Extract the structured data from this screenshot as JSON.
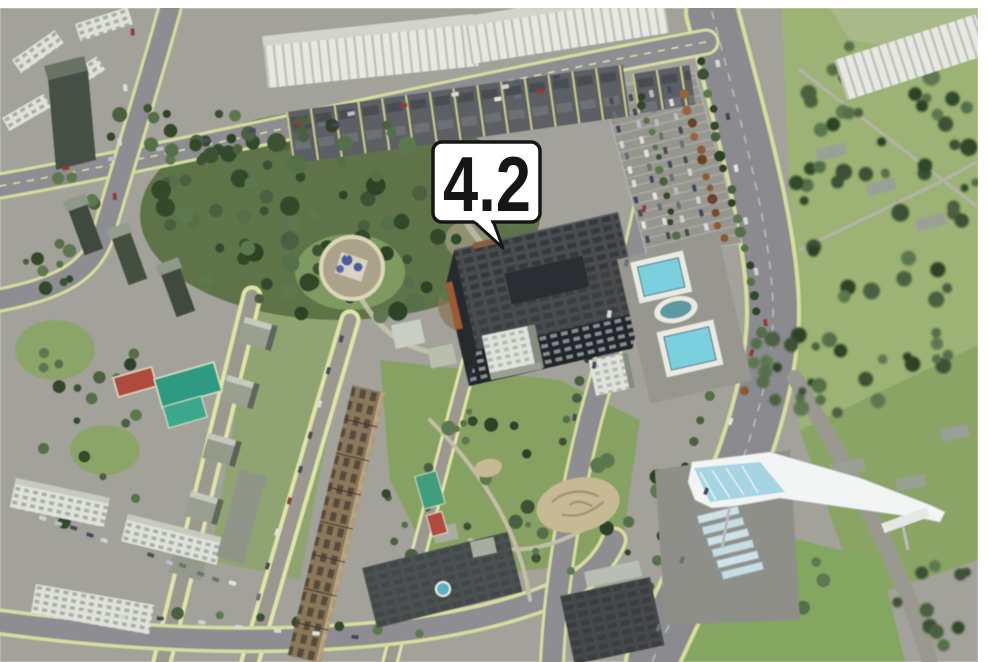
{
  "map": {
    "marker": {
      "label": "4.2",
      "bg_color": "#ffffff",
      "border_color": "#161616",
      "text_color": "#161616"
    },
    "colors": {
      "frame": "#ffffff",
      "ground": "#a3a29a",
      "road": "#8b8b8f",
      "road_edge_marking": "#dce39f",
      "grass": "#8aa465",
      "forest_tree": "#3d5135",
      "highlighted_building_roof": "#43464a",
      "highlighted_building_facade": "#23272b",
      "light_building": "#e5e7e0",
      "brown_building": "#8b775a",
      "pool_water": "#7ccfdd",
      "court_red": "#ae4c3d",
      "court_teal": "#2e9a81",
      "church_dome": "#4b5b9e",
      "bridge_canopy": "#f3f5f4"
    }
  }
}
